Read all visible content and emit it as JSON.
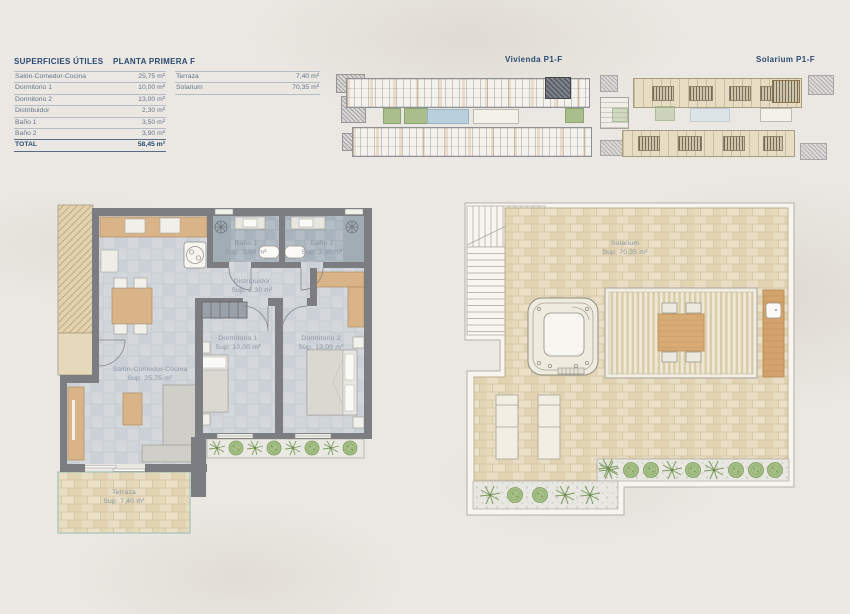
{
  "header": {
    "superficies_title": "SUPERFICIES ÚTILES",
    "planta_title": "PLANTA PRIMERA F",
    "vivienda_map_title": "Vivienda P1-F",
    "solarium_map_title": "Solarium P1-F"
  },
  "surfaces": {
    "rows": [
      {
        "label": "Salón-Comedor-Cocina",
        "value": "25,75 m²"
      },
      {
        "label": "Dormitorio 1",
        "value": "10,00 m²"
      },
      {
        "label": "Dormitorio 2",
        "value": "13,00 m²"
      },
      {
        "label": "Distribuidor",
        "value": "2,30 m²"
      },
      {
        "label": "Baño 1",
        "value": "3,50 m²"
      },
      {
        "label": "Baño 2",
        "value": "3,90 m²"
      },
      {
        "label": "TOTAL",
        "value": "58,45 m²"
      }
    ],
    "extra_rows": [
      {
        "label": "Terraza",
        "value": "7,40 m²"
      },
      {
        "label": "Solarium",
        "value": "70,35 m²"
      }
    ]
  },
  "rooms": {
    "salon": {
      "name": "Salón-Comedor-Cocina",
      "sup": "Sup: 25,75 m²"
    },
    "dormitorio1": {
      "name": "Dormitorio 1",
      "sup": "Sup: 10,00 m²"
    },
    "dormitorio2": {
      "name": "Dormitorio 2",
      "sup": "Sup: 13,00 m²"
    },
    "distribuidor": {
      "name": "Distribuidor",
      "sup": "Sup: 2,30 m²"
    },
    "bano1": {
      "name": "Baño 1",
      "sup": "Sup: 3,50 m²"
    },
    "bano2": {
      "name": "Baño 2",
      "sup": "Sup: 3,90 m²"
    },
    "terraza": {
      "name": "Terraza",
      "sup": "Sup: 7,40 m²"
    },
    "solarium": {
      "name": "Solarium",
      "sup": "Sup: 70,35 m²"
    }
  },
  "colors": {
    "accent_navy": "#2b4a70",
    "table_text": "#66748a",
    "wall_gray": "#7c7d80",
    "wood_tan": "#d9b488",
    "brick_beige": "#e6dabb",
    "tile_gray": "#d4d8dc",
    "bath_tile": "#b4bdc5",
    "plant_green": "#a6bf87",
    "pool_blue": "#b9cfdc",
    "highlight_unit": "#60646c"
  }
}
